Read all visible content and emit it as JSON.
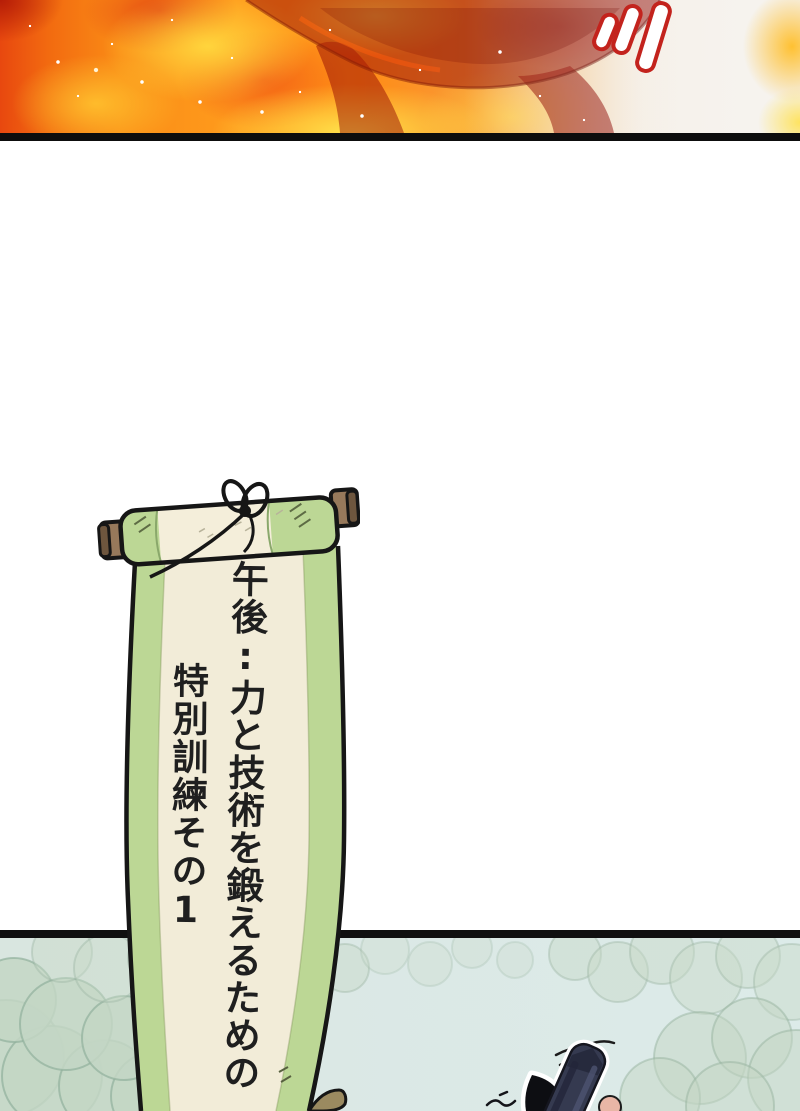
{
  "scroll": {
    "full_text": "午後:力と技術を鍛えるための特別訓練その1",
    "column_right": "午後:力と技術を鍛えるための",
    "column_left": "特別訓練その1",
    "colors": {
      "paper": "#f2ecd8",
      "edge_green": "#bcd795",
      "rod_wood": "#97795b",
      "outline_ink": "#161616",
      "text_ink": "#1f1f1f"
    }
  },
  "fire_panel": {
    "impact_marks_count": 3,
    "colors": {
      "flame_core_yellow": "#ffdf4d",
      "flame_orange": "#ff9c1d",
      "flame_red": "#e8480f",
      "burning_silhouette": "#9a1410",
      "smoke_white": "#f5f2ee",
      "impact_mark_outline": "#c3231d",
      "panel_border": "#0d0d0d"
    }
  },
  "forest_panel": {
    "colors": {
      "sky_teal": "#dbe8e5",
      "bush_green": "#c3d6c4",
      "bush_outline": "#92b09c",
      "weapon_dark": "#353a50",
      "horn_black": "#0d0e12",
      "skin_pink": "#e9b6a6",
      "panel_border": "#101010"
    }
  }
}
